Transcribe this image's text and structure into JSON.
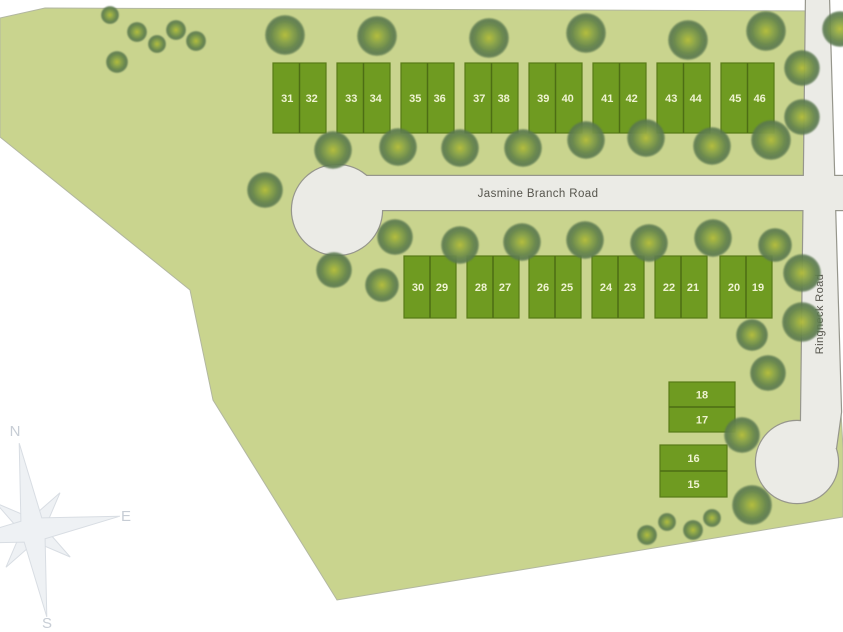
{
  "map": {
    "background_color": "#ffffff",
    "parcel": {
      "fill": "#c9d48e",
      "outline": "#b2b7a0",
      "points": [
        [
          0,
          18
        ],
        [
          45,
          8
        ],
        [
          829,
          11
        ],
        [
          841,
          412
        ],
        [
          843,
          448
        ],
        [
          843,
          517
        ],
        [
          337,
          600
        ],
        [
          213,
          400
        ],
        [
          190,
          290
        ],
        [
          0,
          137
        ]
      ]
    },
    "roads": {
      "fill": "#ebebe6",
      "outline": "#96968c",
      "label_color": "#56554d",
      "items": [
        {
          "id": "jasmine-branch-road",
          "label": "Jasmine Branch Road",
          "label_x": 538,
          "label_y": 197,
          "label_rotation": 0,
          "label_size": 11.5,
          "shapes": [
            {
              "type": "rect",
              "x": 337,
              "y": 176,
              "w": 506,
              "h": 34
            },
            {
              "type": "circle",
              "cx": 337,
              "cy": 210,
              "r": 45,
              "name": "culdesac-jasmine"
            }
          ]
        },
        {
          "id": "ringneck-road",
          "label": "Ringneck Road",
          "label_x": 823,
          "label_y": 314,
          "label_rotation": -90,
          "label_size": 11,
          "shapes": [
            {
              "type": "polygon",
              "points": [
                [
                  806,
                  0
                ],
                [
                  829,
                  0
                ],
                [
                  841,
                  412
                ],
                [
                  836,
                  448
                ],
                [
                  800,
                  452
                ],
                [
                  801,
                  425
                ]
              ]
            },
            {
              "type": "circle",
              "cx": 797,
              "cy": 462,
              "r": 41,
              "name": "culdesac-ringneck"
            }
          ]
        }
      ]
    },
    "lots": {
      "fill": "#6f9b21",
      "border": "#587a17",
      "divider": "#4d6d14",
      "number_color": "#eff3d2",
      "number_size": 11,
      "blocks": [
        {
          "x": 273,
          "y": 63,
          "w": 53,
          "h": 70,
          "split": "v",
          "numbers": [
            "31",
            "32"
          ]
        },
        {
          "x": 337,
          "y": 63,
          "w": 53,
          "h": 70,
          "split": "v",
          "numbers": [
            "33",
            "34"
          ]
        },
        {
          "x": 401,
          "y": 63,
          "w": 53,
          "h": 70,
          "split": "v",
          "numbers": [
            "35",
            "36"
          ]
        },
        {
          "x": 465,
          "y": 63,
          "w": 53,
          "h": 70,
          "split": "v",
          "numbers": [
            "37",
            "38"
          ]
        },
        {
          "x": 529,
          "y": 63,
          "w": 53,
          "h": 70,
          "split": "v",
          "numbers": [
            "39",
            "40"
          ]
        },
        {
          "x": 593,
          "y": 63,
          "w": 53,
          "h": 70,
          "split": "v",
          "numbers": [
            "41",
            "42"
          ]
        },
        {
          "x": 657,
          "y": 63,
          "w": 53,
          "h": 70,
          "split": "v",
          "numbers": [
            "43",
            "44"
          ]
        },
        {
          "x": 721,
          "y": 63,
          "w": 53,
          "h": 70,
          "split": "v",
          "numbers": [
            "45",
            "46"
          ]
        },
        {
          "x": 404,
          "y": 256,
          "w": 52,
          "h": 62,
          "split": "v",
          "numbers": [
            "30",
            "29"
          ]
        },
        {
          "x": 467,
          "y": 256,
          "w": 52,
          "h": 62,
          "split": "v",
          "numbers": [
            "28",
            "27"
          ]
        },
        {
          "x": 529,
          "y": 256,
          "w": 52,
          "h": 62,
          "split": "v",
          "numbers": [
            "26",
            "25"
          ]
        },
        {
          "x": 592,
          "y": 256,
          "w": 52,
          "h": 62,
          "split": "v",
          "numbers": [
            "24",
            "23"
          ]
        },
        {
          "x": 655,
          "y": 256,
          "w": 52,
          "h": 62,
          "split": "v",
          "numbers": [
            "22",
            "21"
          ]
        },
        {
          "x": 720,
          "y": 256,
          "w": 52,
          "h": 62,
          "split": "v",
          "numbers": [
            "20",
            "19"
          ]
        },
        {
          "x": 669,
          "y": 382,
          "w": 66,
          "h": 50,
          "split": "h",
          "numbers": [
            "18",
            "17"
          ]
        },
        {
          "x": 660,
          "y": 445,
          "w": 67,
          "h": 52,
          "split": "h",
          "numbers": [
            "16",
            "15"
          ]
        }
      ]
    },
    "trees": {
      "colors": {
        "core": "#b4bd3a",
        "mid": "#8ba447",
        "edge": "#59774e"
      },
      "items": [
        [
          110,
          15,
          9
        ],
        [
          137,
          32,
          10
        ],
        [
          157,
          44,
          9
        ],
        [
          176,
          30,
          10
        ],
        [
          196,
          41,
          10
        ],
        [
          117,
          62,
          11
        ],
        [
          285,
          35,
          20
        ],
        [
          377,
          36,
          20
        ],
        [
          489,
          38,
          20
        ],
        [
          586,
          33,
          20
        ],
        [
          688,
          40,
          20
        ],
        [
          766,
          31,
          20
        ],
        [
          840,
          29,
          18
        ],
        [
          333,
          150,
          19
        ],
        [
          398,
          147,
          19
        ],
        [
          460,
          148,
          19
        ],
        [
          523,
          148,
          19
        ],
        [
          586,
          140,
          19
        ],
        [
          646,
          138,
          19
        ],
        [
          712,
          146,
          19
        ],
        [
          771,
          140,
          20
        ],
        [
          265,
          190,
          18
        ],
        [
          395,
          237,
          18
        ],
        [
          460,
          245,
          19
        ],
        [
          522,
          242,
          19
        ],
        [
          585,
          240,
          19
        ],
        [
          649,
          243,
          19
        ],
        [
          713,
          238,
          19
        ],
        [
          775,
          245,
          17
        ],
        [
          802,
          68,
          18
        ],
        [
          802,
          117,
          18
        ],
        [
          802,
          273,
          19
        ],
        [
          802,
          322,
          20
        ],
        [
          334,
          270,
          18
        ],
        [
          382,
          285,
          17
        ],
        [
          752,
          335,
          16
        ],
        [
          768,
          373,
          18
        ],
        [
          742,
          435,
          18
        ],
        [
          752,
          505,
          20
        ],
        [
          647,
          535,
          10
        ],
        [
          667,
          522,
          9
        ],
        [
          693,
          530,
          10
        ],
        [
          712,
          518,
          9
        ]
      ]
    },
    "compass": {
      "fill": "#eef1f4",
      "stroke": "#d8dde3",
      "label_color": "#c7cdd5",
      "label_size": 15,
      "cx": 33,
      "cy": 530,
      "long_r": 88,
      "long_waist": 15,
      "short_r": 46,
      "short_waist": 12,
      "rotation_deg": 9,
      "labels": [
        {
          "text": "N",
          "x": 15,
          "y": 436
        },
        {
          "text": "E",
          "x": 126,
          "y": 521
        },
        {
          "text": "S",
          "x": 47,
          "y": 628
        }
      ]
    }
  }
}
